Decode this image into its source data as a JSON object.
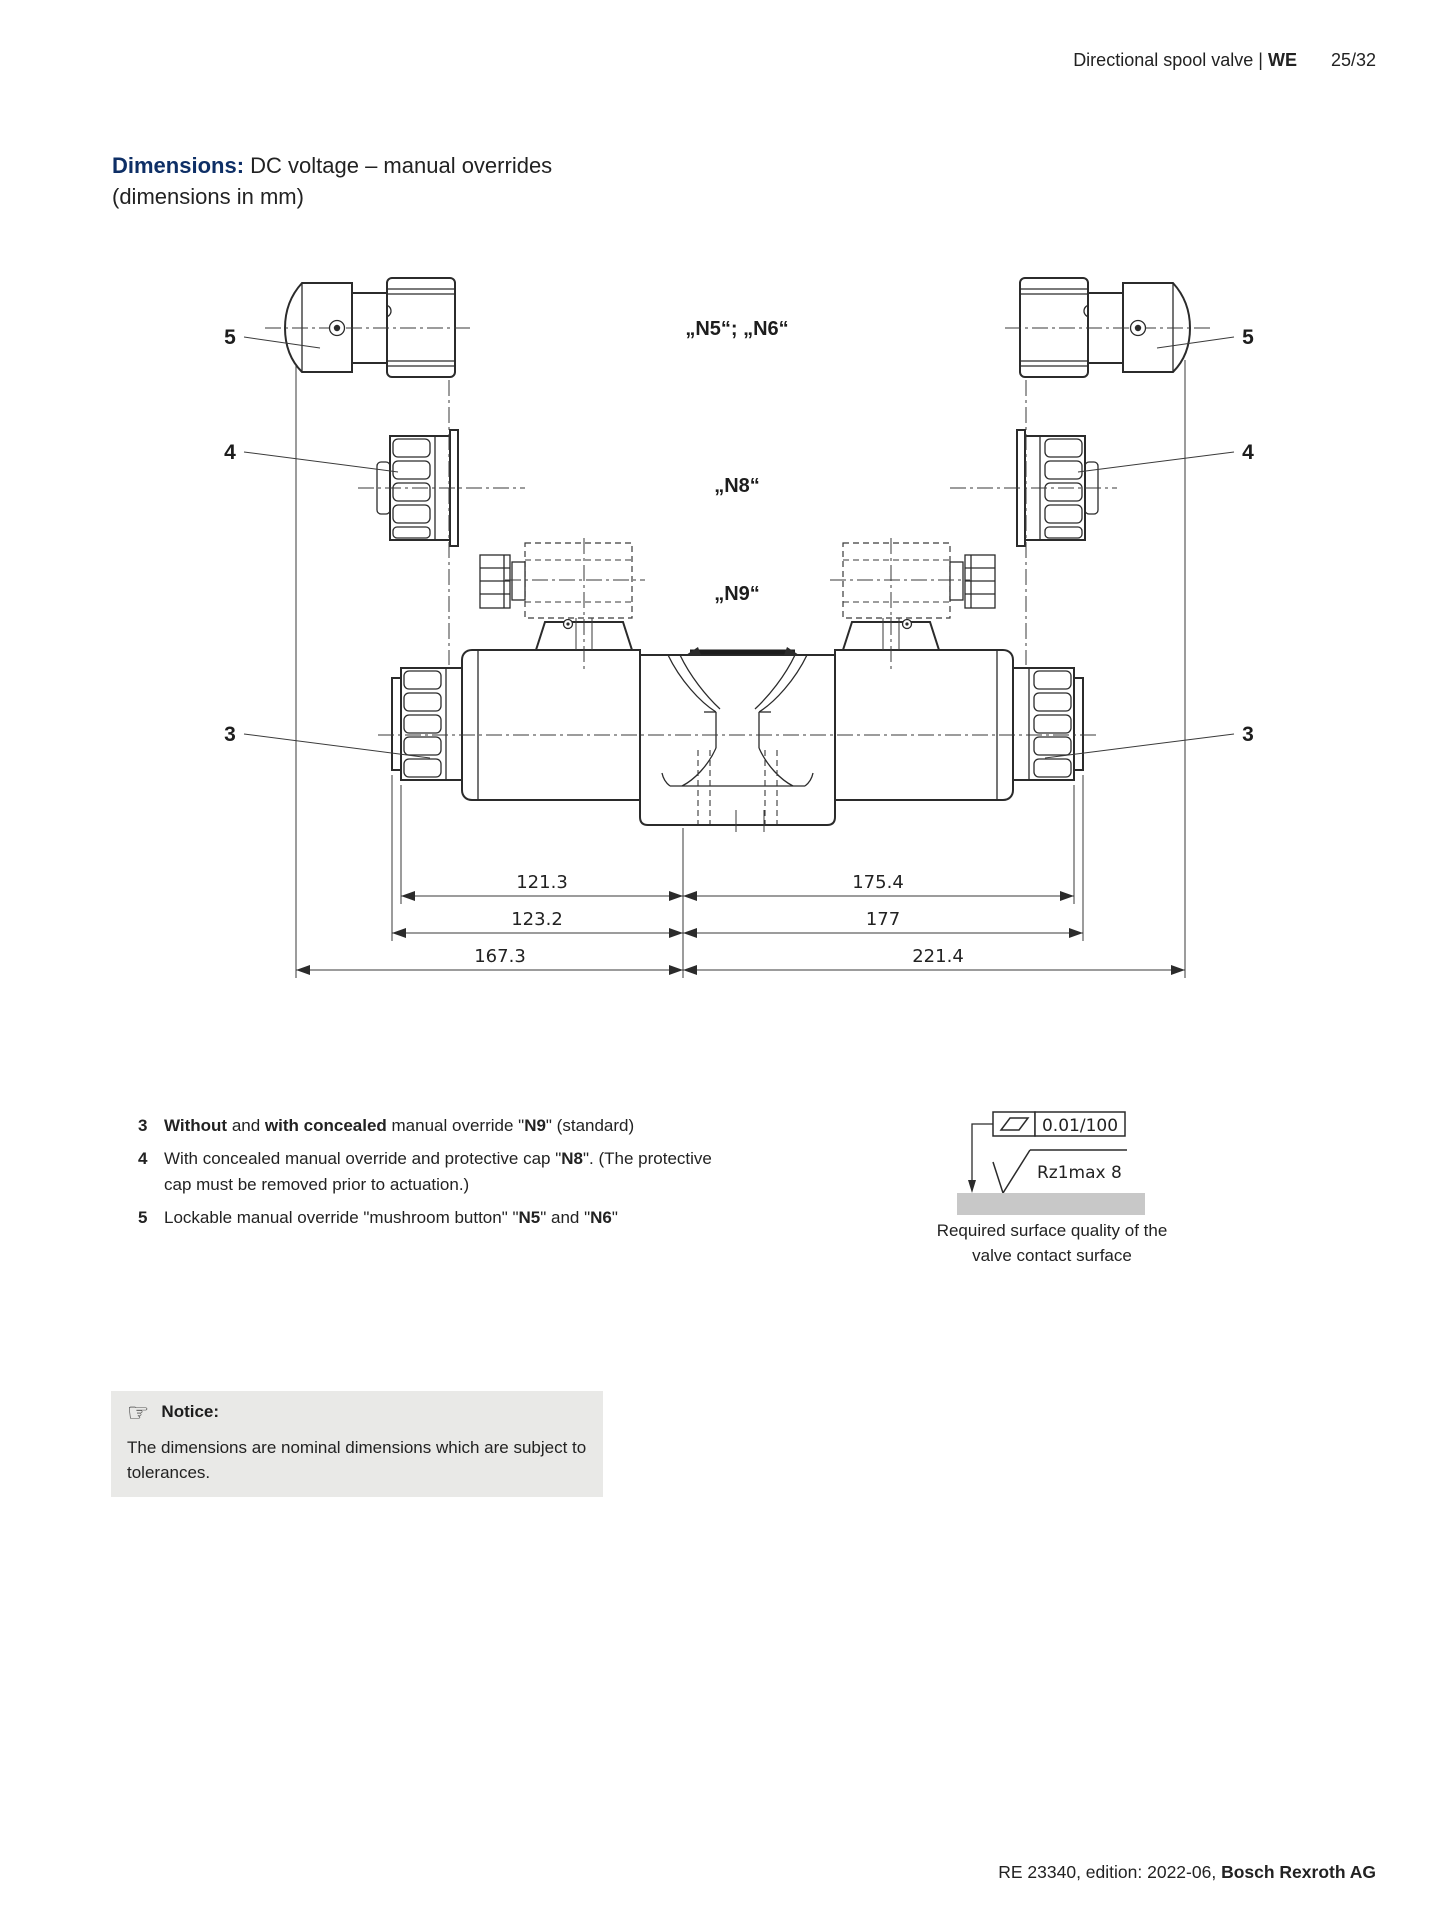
{
  "header": {
    "product": "Directional spool valve | ",
    "series": "WE",
    "page": "25/32"
  },
  "title": {
    "lead": "Dimensions:",
    "rest": " DC voltage – manual overrides",
    "line2": "(dimensions in mm)"
  },
  "diagram": {
    "labels": {
      "item5": "5",
      "item4": "4",
      "item3": "3",
      "n5n6": "„N5“; „N6“",
      "n8": "„N8“",
      "n9": "„N9“"
    },
    "dimensions": {
      "row1_left": "121.3",
      "row1_right": "175.4",
      "row2_left": "123.2",
      "row2_right": "177",
      "row3_left": "167.3",
      "row3_right": "221.4"
    }
  },
  "legend": {
    "items": [
      {
        "num": "3",
        "segments": [
          {
            "t": "Without",
            "b": true
          },
          {
            "t": " and ",
            "b": false
          },
          {
            "t": "with concealed",
            "b": true
          },
          {
            "t": " manual override \"",
            "b": false
          },
          {
            "t": "N9",
            "b": true
          },
          {
            "t": "\" (standard)",
            "b": false
          }
        ]
      },
      {
        "num": "4",
        "segments": [
          {
            "t": "With concealed manual override and protective cap \"",
            "b": false
          },
          {
            "t": "N8",
            "b": true
          },
          {
            "t": "\". (The protective cap must be removed prior to actuation.)",
            "b": false
          }
        ]
      },
      {
        "num": "5",
        "segments": [
          {
            "t": "Lockable manual override \"mushroom button\" \"",
            "b": false
          },
          {
            "t": "N5",
            "b": true
          },
          {
            "t": "\" and \"",
            "b": false
          },
          {
            "t": "N6",
            "b": true
          },
          {
            "t": "\"",
            "b": false
          }
        ]
      }
    ]
  },
  "surface": {
    "flatness": "0.01/100",
    "roughness": "Rz1max 8",
    "caption_line1": "Required surface quality of the",
    "caption_line2": "valve contact surface"
  },
  "notice": {
    "icon": "☞",
    "title": "Notice:",
    "body": "The dimensions are nominal dimensions which are subject to tolerances."
  },
  "footer": {
    "text": "RE 23340, edition: 2022-06, ",
    "bold": "Bosch Rexroth AG"
  }
}
